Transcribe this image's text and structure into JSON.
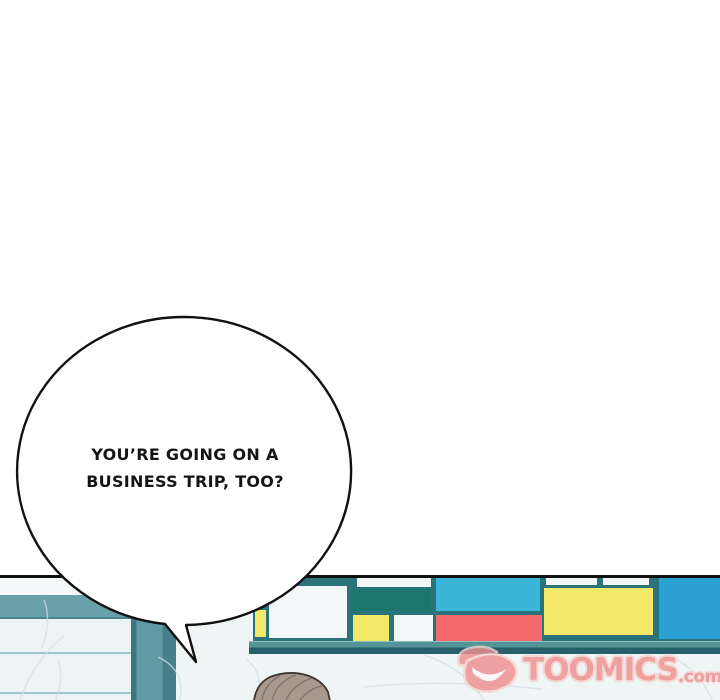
{
  "comic": {
    "speech_bubble": {
      "line1": "YOU’RE GOING ON A",
      "line2": "BUSINESS TRIP, TOO?"
    },
    "watermark": {
      "brand": "TOOMICS",
      "tld": ".com",
      "color": "#ef8f8f",
      "icon": "toomics-wing-smile-logo"
    },
    "palette": {
      "panel_border": "#101010",
      "wall_teal_band": "#6aa0aa",
      "pillar_teal": "#609ba5",
      "marble": "#eff4f5",
      "mondrian_frame": "#2b737b",
      "ledge_top": "#539499",
      "ledge_front": "#26616b",
      "hair": "#a8998f"
    },
    "mondrian_blocks": [
      {
        "name": "block-yellow-strip-left",
        "color": "#f2e968",
        "x": 2,
        "y": 32,
        "w": 11,
        "h": 27
      },
      {
        "name": "block-white-large-left",
        "color": "#f3f7f7",
        "x": 16,
        "y": 8,
        "w": 78,
        "h": 52
      },
      {
        "name": "block-white-strip-1",
        "color": "#f3f7f7",
        "x": 104,
        "y": 0,
        "w": 74,
        "h": 9
      },
      {
        "name": "block-dark-teal",
        "color": "#1e756c",
        "x": 99,
        "y": 11,
        "w": 79,
        "h": 22
      },
      {
        "name": "block-yellow-small",
        "color": "#f2e968",
        "x": 100,
        "y": 37,
        "w": 36,
        "h": 26
      },
      {
        "name": "block-white-small",
        "color": "#f3f7f7",
        "x": 141,
        "y": 37,
        "w": 39,
        "h": 26
      },
      {
        "name": "block-cyan",
        "color": "#3ab5d8",
        "x": 183,
        "y": 0,
        "w": 104,
        "h": 33
      },
      {
        "name": "block-red",
        "color": "#f5696c",
        "x": 183,
        "y": 37,
        "w": 106,
        "h": 26
      },
      {
        "name": "block-white-strip-2",
        "color": "#f3f7f7",
        "x": 293,
        "y": 0,
        "w": 51,
        "h": 7
      },
      {
        "name": "block-white-strip-3",
        "color": "#f3f7f7",
        "x": 350,
        "y": 0,
        "w": 46,
        "h": 7
      },
      {
        "name": "block-yellow-large",
        "color": "#f2e968",
        "x": 291,
        "y": 10,
        "w": 109,
        "h": 47
      },
      {
        "name": "block-blue-right",
        "color": "#2da0d3",
        "x": 406,
        "y": 0,
        "w": 61,
        "h": 61
      }
    ]
  }
}
